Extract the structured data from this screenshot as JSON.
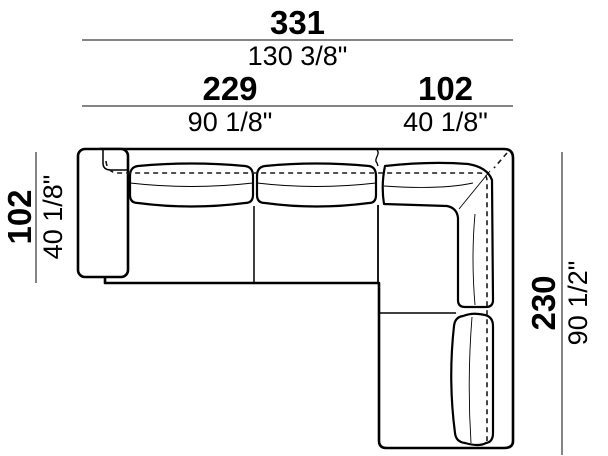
{
  "diagram": {
    "type": "sectional-sofa-top-view-dimension-drawing",
    "units": [
      "cm",
      "inches"
    ],
    "dimensions": {
      "overall_width": {
        "cm": "331",
        "inches": "130 3/8\""
      },
      "left_section": {
        "cm": "229",
        "inches": "90 1/8\""
      },
      "right_section": {
        "cm": "102",
        "inches": "40 1/8\""
      },
      "depth_left": {
        "cm": "102",
        "inches": "40 1/8\""
      },
      "depth_right": {
        "cm": "230",
        "inches": "90 1/2\""
      }
    },
    "colors": {
      "dimension_line": "#858585",
      "drawing_line": "#000000",
      "text": "#000000",
      "background": "#ffffff"
    }
  }
}
